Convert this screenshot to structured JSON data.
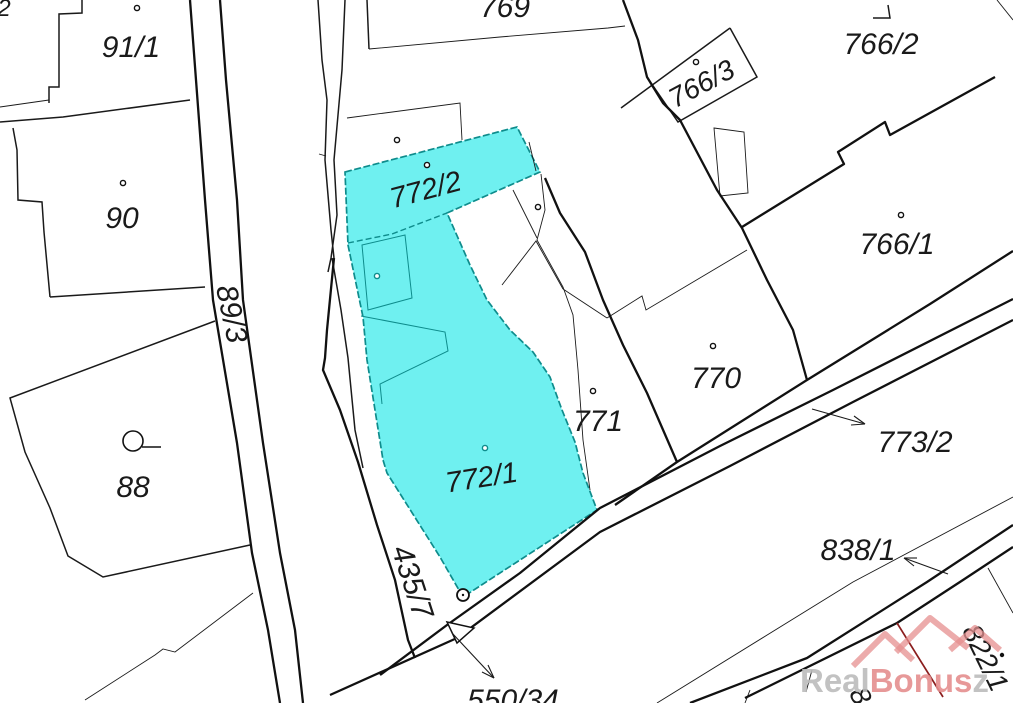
{
  "map": {
    "type": "cadastral-parcel-map",
    "colors": {
      "background": "#ffffff",
      "line": "#1a1a1a",
      "highlight_fill": "#6FF0F0",
      "highlight_stroke": "#0E8C8C",
      "highlight_label": "#1E7F7F",
      "red_boundary": "#8B1E1E",
      "watermark_gray": "#BCBCBC",
      "watermark_red": "#E58F8F"
    },
    "highlighted_parcels": [
      "772/2",
      "772/1"
    ],
    "labels": [
      {
        "text": "2",
        "x": 4,
        "y": 16,
        "rot": 0,
        "size": 24,
        "color": "line"
      },
      {
        "text": "91/1",
        "x": 131,
        "y": 57,
        "rot": 0,
        "size": 30,
        "color": "line"
      },
      {
        "text": "90",
        "x": 122,
        "y": 228,
        "rot": 0,
        "size": 30,
        "color": "line"
      },
      {
        "text": "89/3",
        "x": 222,
        "y": 316,
        "rot": 78,
        "size": 30,
        "color": "line"
      },
      {
        "text": "88",
        "x": 133,
        "y": 497,
        "rot": 0,
        "size": 30,
        "color": "line"
      },
      {
        "text": "769",
        "x": 505,
        "y": 17,
        "rot": 0,
        "size": 30,
        "color": "line"
      },
      {
        "text": "766/3",
        "x": 706,
        "y": 92,
        "rot": -28,
        "size": 28,
        "color": "line"
      },
      {
        "text": "766/2",
        "x": 881,
        "y": 54,
        "rot": 0,
        "size": 30,
        "color": "line"
      },
      {
        "text": "766/1",
        "x": 897,
        "y": 254,
        "rot": 0,
        "size": 30,
        "color": "line"
      },
      {
        "text": "770",
        "x": 716,
        "y": 388,
        "rot": 0,
        "size": 30,
        "color": "line"
      },
      {
        "text": "771",
        "x": 598,
        "y": 431,
        "rot": 0,
        "size": 30,
        "color": "line"
      },
      {
        "text": "772/2",
        "x": 428,
        "y": 199,
        "rot": -15,
        "size": 29,
        "color": "highlight_label"
      },
      {
        "text": "772/1",
        "x": 483,
        "y": 487,
        "rot": -9,
        "size": 29,
        "color": "highlight_label"
      },
      {
        "text": "773/2",
        "x": 915,
        "y": 452,
        "rot": 0,
        "size": 30,
        "color": "line"
      },
      {
        "text": "838/1",
        "x": 858,
        "y": 560,
        "rot": 0,
        "size": 30,
        "color": "line"
      },
      {
        "text": "435/7",
        "x": 403,
        "y": 585,
        "rot": 72,
        "size": 30,
        "color": "line"
      },
      {
        "text": "550/34",
        "x": 513,
        "y": 710,
        "rot": 0,
        "size": 30,
        "color": "line"
      },
      {
        "text": "822/1",
        "x": 977,
        "y": 662,
        "rot": 64,
        "size": 28,
        "color": "line"
      },
      {
        "text": "8",
        "x": 852,
        "y": 700,
        "rot": 64,
        "size": 28,
        "color": "line"
      }
    ],
    "symbols": {
      "building_dots": [
        {
          "x": 137,
          "y": 8,
          "style": "black"
        },
        {
          "x": 123,
          "y": 183,
          "style": "black"
        },
        {
          "x": 397,
          "y": 140,
          "style": "black"
        },
        {
          "x": 427,
          "y": 165,
          "style": "black"
        },
        {
          "x": 538,
          "y": 207,
          "style": "black"
        },
        {
          "x": 593,
          "y": 391,
          "style": "black"
        },
        {
          "x": 713,
          "y": 346,
          "style": "black"
        },
        {
          "x": 901,
          "y": 215,
          "style": "black"
        },
        {
          "x": 696,
          "y": 62,
          "style": "black"
        },
        {
          "x": 377,
          "y": 276,
          "style": "teal"
        },
        {
          "x": 485,
          "y": 448,
          "style": "teal"
        },
        {
          "x": 1002,
          "y": 655,
          "style": "solid"
        }
      ],
      "well_symbol": {
        "x": 133,
        "y": 441,
        "r": 10,
        "tail_x2": 161,
        "tail_y2": 447
      },
      "boundary_point_circle": {
        "x": 463,
        "y": 595,
        "r": 6
      }
    },
    "watermark": {
      "part_gray": "Real",
      "part_red": "Bonus",
      "part_tail": "z",
      "x": 800,
      "y": 692,
      "size": 33,
      "logo_name": "red-roofs-logo"
    }
  }
}
